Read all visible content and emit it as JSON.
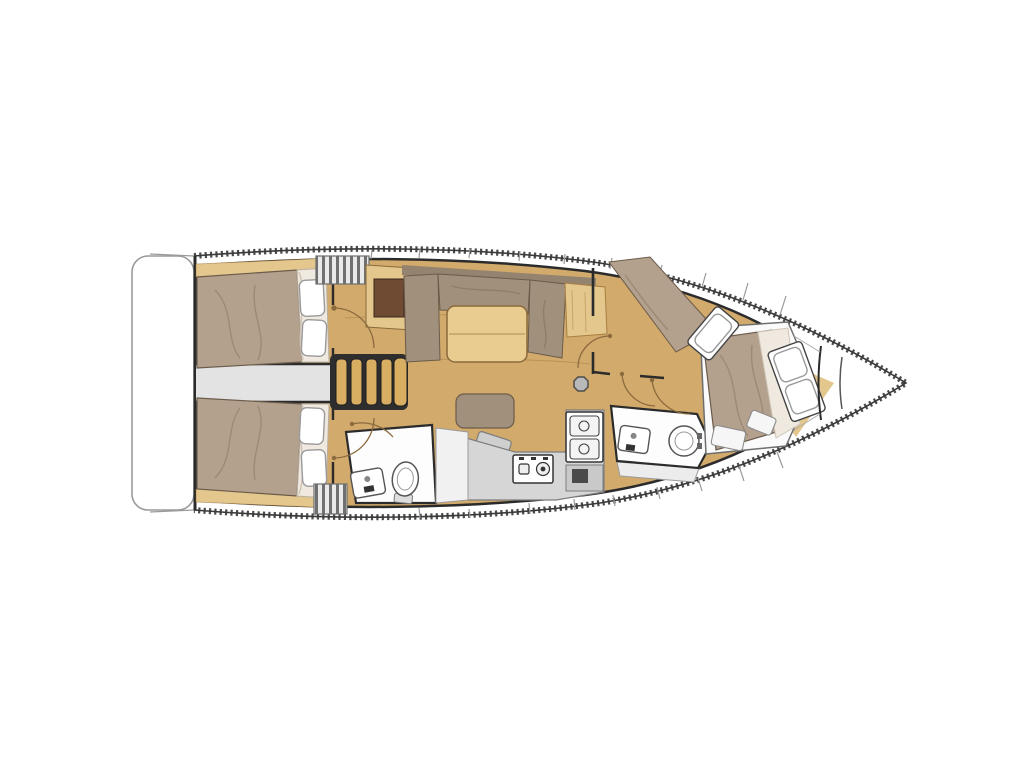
{
  "page": {
    "background": "#ffffff"
  },
  "plan": {
    "title": "Sailing yacht interior layout floor plan, top view, bow pointing right",
    "orientation": "bow-right",
    "rooms": [
      {
        "id": "transom-platform",
        "label": "Transom swim platform"
      },
      {
        "id": "aft-cabin-port",
        "label": "Aft double cabin (port) with berth and two pillows"
      },
      {
        "id": "aft-cabin-starboard",
        "label": "Aft double cabin (starboard) with berth and two pillows"
      },
      {
        "id": "companionway",
        "label": "Companionway with four wooden steps"
      },
      {
        "id": "saloon",
        "label": "Saloon with U-settee, dining table, bench and mast post"
      },
      {
        "id": "galley",
        "label": "Galley with two-burner stove, double sink and fridge"
      },
      {
        "id": "aft-head",
        "label": "Aft head with toilet and washbasin"
      },
      {
        "id": "forward-head",
        "label": "Forward head with toilet and washbasin"
      },
      {
        "id": "forward-cabin",
        "label": "Forward cabin with angled island double berth and side berth"
      },
      {
        "id": "bow-locker",
        "label": "Bow anchor locker"
      }
    ],
    "fixtures": {
      "double_berths": 3,
      "single_berths": 1,
      "pillows": 7,
      "toilets": 2,
      "washbasins": 2,
      "stove_burners": 2,
      "sink_bowls": 2,
      "companionway_steps": 4,
      "door_swings": 6,
      "mast_posts": 1
    }
  },
  "colors": {
    "background": "#ffffff",
    "hull_line": "#3a3a3a",
    "toe_rail": "#4a4a4a",
    "deck": "#ffffff",
    "deck_line": "#9a9a9a",
    "wall": "#2b2b2b",
    "corridor": "#e3e3e3",
    "floor_wood": "#d2aa6b",
    "furniture_wood": "#e4c78c",
    "wood_dark": "#6f4b33",
    "step_wood": "#d8ae63",
    "mattress": "#b3a08d",
    "cushion": "#a1907b",
    "cushion_dark": "#93836f",
    "sheet": "#efe9e0",
    "pillow": "#ffffff",
    "pillow_line": "#9a9a9a",
    "table_wood": "#e8cc90",
    "counter": "#d6d6d6",
    "counter_line": "#7d7d7d",
    "fixture_white": "#fdfdfd",
    "fixture_line": "#555555",
    "door": "#8b6a3e",
    "grate_light": "#e9e9e9",
    "grate_dark": "#707070",
    "mast": "#b9b9b9"
  }
}
